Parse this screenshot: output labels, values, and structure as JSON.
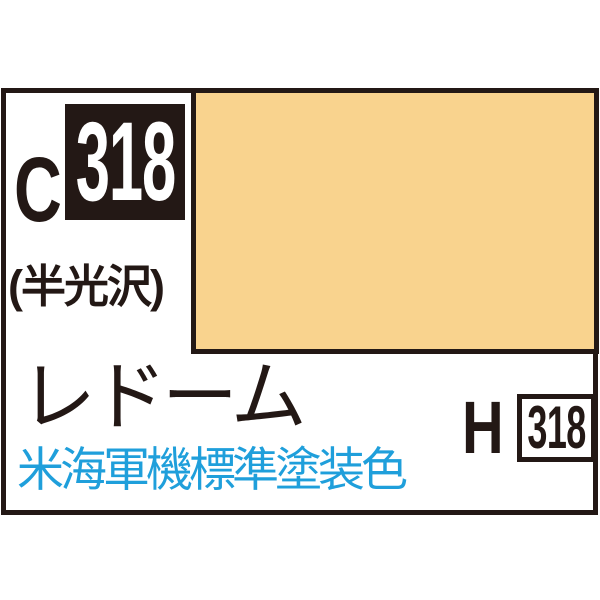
{
  "product": {
    "logo": {
      "prefix": "C",
      "number": "318"
    },
    "finish_label": "(半光沢)",
    "swatch": {
      "color_hex": "#F9D38E"
    },
    "color_name": "レドーム",
    "aqueous_equivalent": {
      "prefix": "H",
      "number": "318"
    },
    "usage_note": "米海軍機標準塗装色"
  },
  "colors": {
    "ink_black": "#231815",
    "note_blue": "#1F9FDB",
    "swatch_tan": "#F9D38E",
    "background": "#FFFFFF"
  }
}
